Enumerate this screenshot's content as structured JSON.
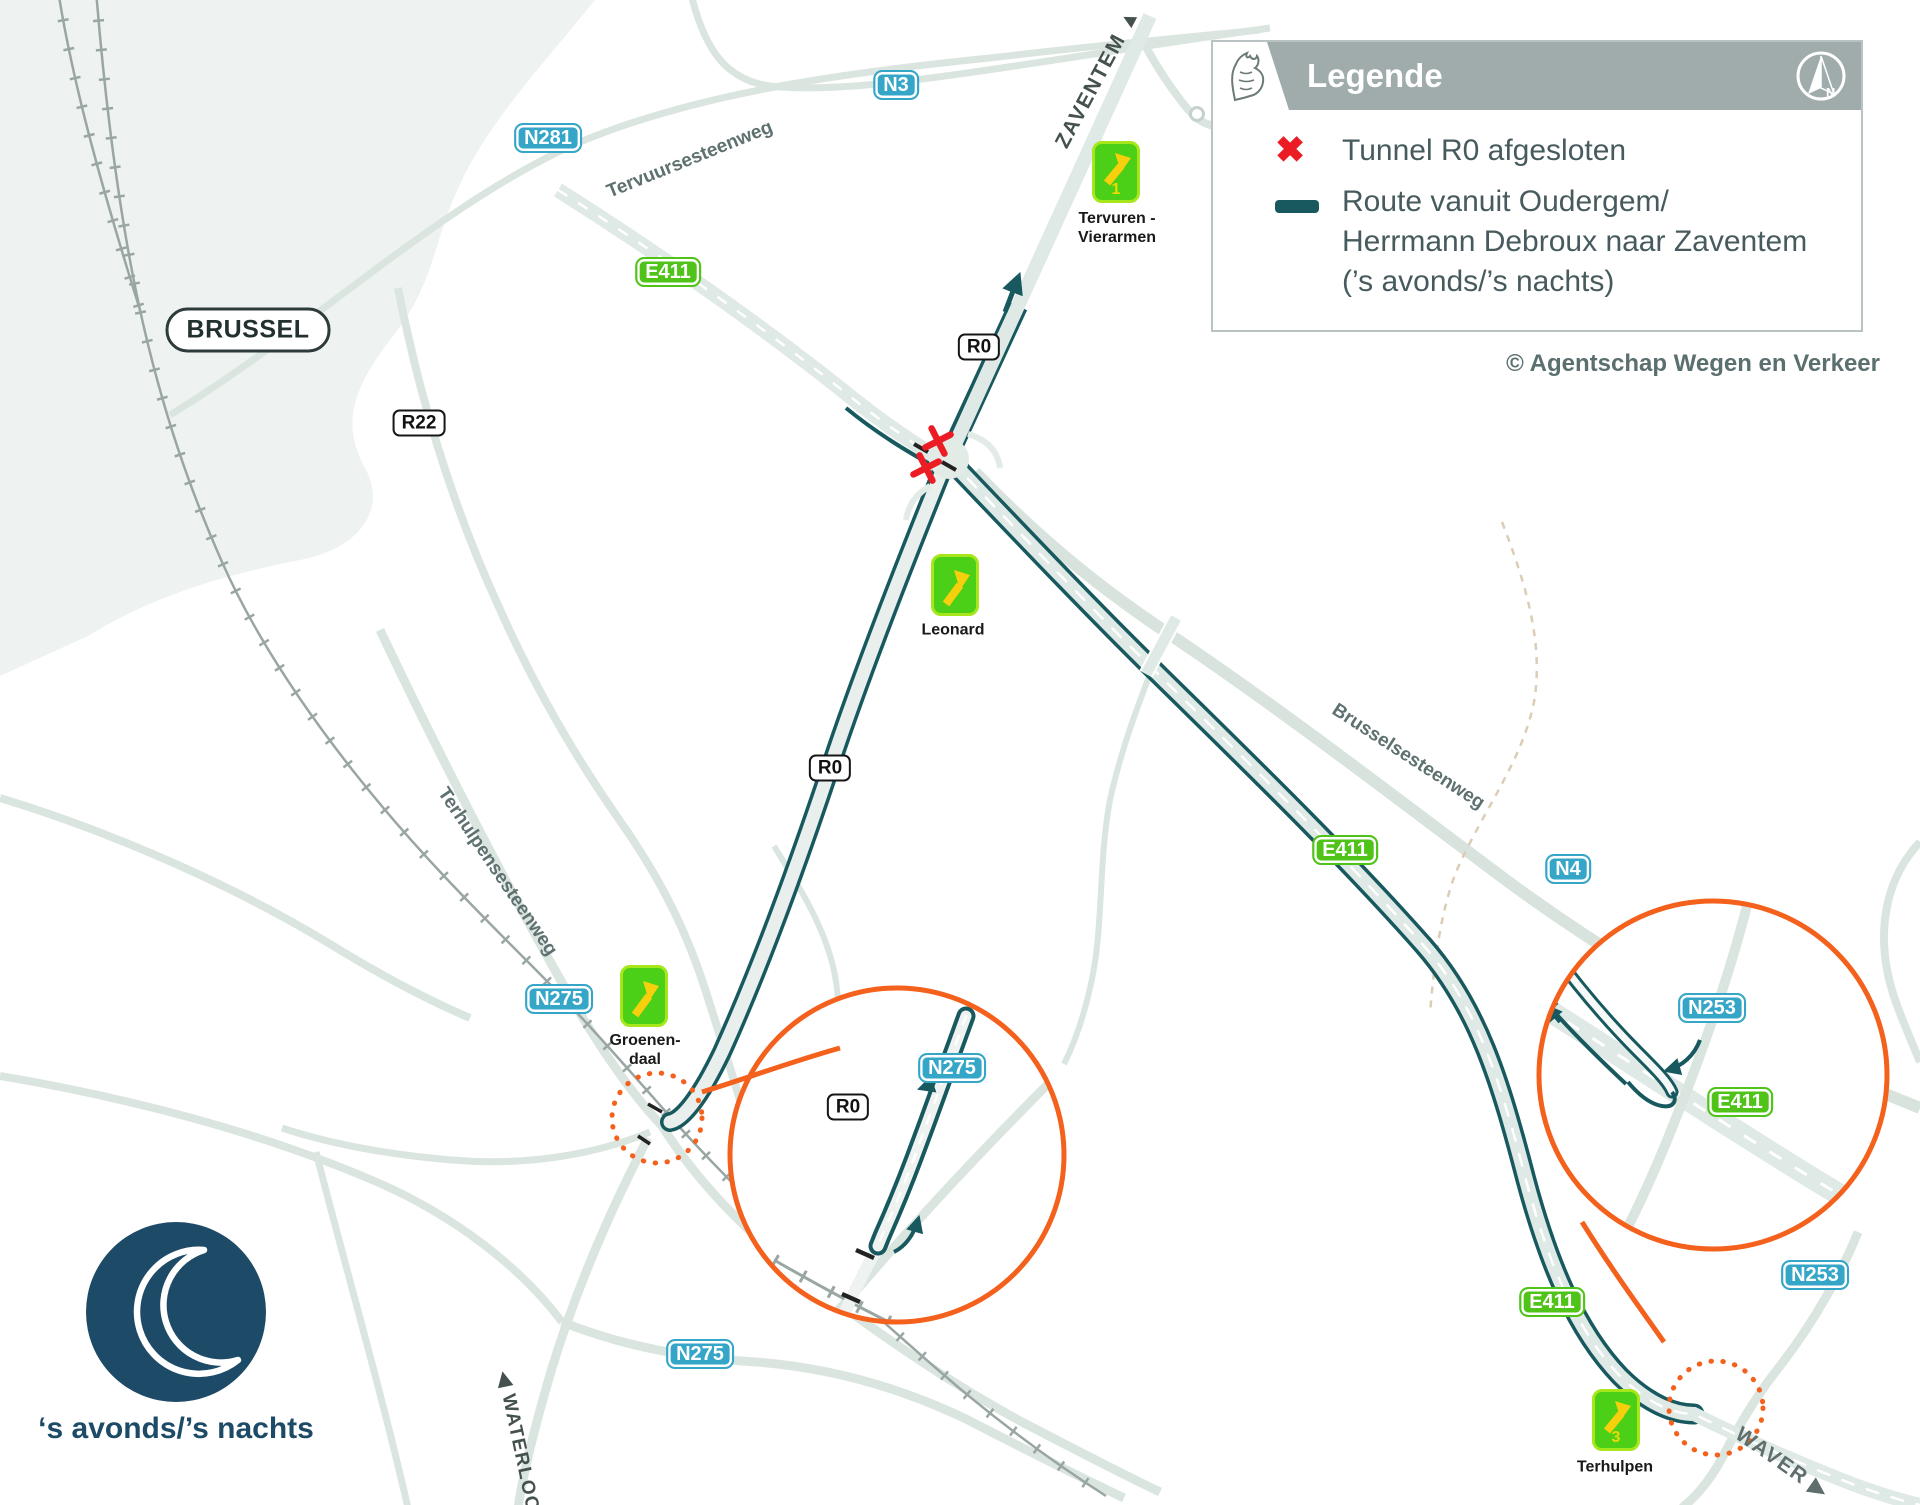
{
  "colors": {
    "route_teal": "#17595f",
    "closed_red": "#ec1c24",
    "highlight_orange": "#f4611c",
    "exit_sign_green": "#4ccf17",
    "road_sign_blue": "#35a6c8",
    "road_sign_green": "#4fc318",
    "night_navy": "#1d4a66",
    "legend_gray": "#a0acac"
  },
  "legend": {
    "title": "Legende",
    "compass_label": "N",
    "items": [
      {
        "icon": "closed-x",
        "label": "Tunnel R0 afgesloten"
      },
      {
        "icon": "route-line",
        "label_line1": "Route vanuit Oudergem/",
        "label_line2": "Herrmann Debroux naar Zaventem",
        "label_line3": "(’s avonds/’s nachts)"
      }
    ],
    "credit": "© Agentschap Wegen en Verkeer"
  },
  "night_badge": {
    "label": "‘s avonds/’s nachts"
  },
  "places": {
    "brussel": "BRUSSEL",
    "zaventem": "ZAVENTEM",
    "waterloo": "WATERLOO",
    "waver": "WAVER"
  },
  "direction_arrows": {
    "up": "▲",
    "right": "▶",
    "left": "◀"
  },
  "streets": {
    "tervuursesteenweg": "Tervuursesteenweg",
    "terhulpensesteenweg": "Terhulpensesteenweg",
    "brusselsesteenweg": "Brusselsesteenweg"
  },
  "road_signs": {
    "n3": "N3",
    "n281": "N281",
    "n4": "N4",
    "n253": "N253",
    "n275": "N275",
    "e411": "E411",
    "r0": "R0",
    "r22": "R22"
  },
  "exits": {
    "tervuren": {
      "number": "1",
      "line1": "Tervuren -",
      "line2": "Vierarmen"
    },
    "leonard": {
      "number": "",
      "line1": "Leonard",
      "line2": ""
    },
    "groenendaal": {
      "number": "",
      "line1": "Groenen-",
      "line2": "daal"
    },
    "terhulpen": {
      "number": "3",
      "line1": "Terhulpen",
      "line2": ""
    }
  }
}
